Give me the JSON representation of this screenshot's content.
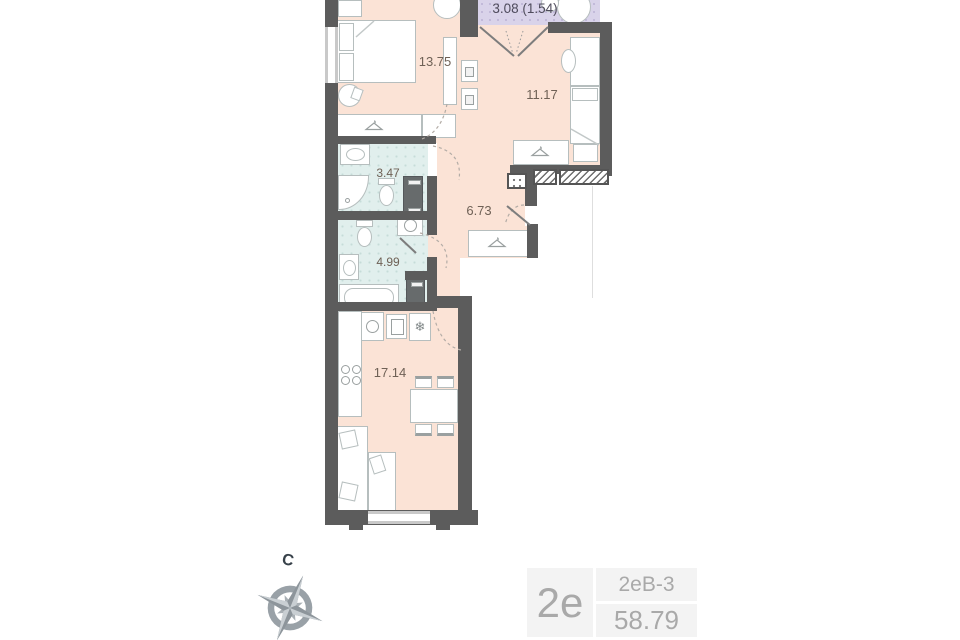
{
  "plan": {
    "rooms": [
      {
        "name": "balcony",
        "area_label": "3.08 (1.54)"
      },
      {
        "name": "bedroom",
        "area_label": "13.75"
      },
      {
        "name": "bedroom-2",
        "area_label": "11.17"
      },
      {
        "name": "shower-room",
        "area_label": "3.47"
      },
      {
        "name": "hallway",
        "area_label": "6.73"
      },
      {
        "name": "bathroom",
        "area_label": "4.99"
      },
      {
        "name": "kitchen-living-room",
        "area_label": "17.14"
      }
    ],
    "icons": {
      "fridge": "❄"
    },
    "colors": {
      "room_fill": "#fbe3d6",
      "wet_room_fill": "#e1efed",
      "balcony_fill": "#d9d3ea",
      "wall": "#5c5c5c",
      "furniture_stroke": "#b6bebe"
    }
  },
  "compass": {
    "north_label": "С"
  },
  "info_card": {
    "apartment_type": "2е",
    "layout_code": "2еВ-3",
    "total_area": "58.79"
  }
}
